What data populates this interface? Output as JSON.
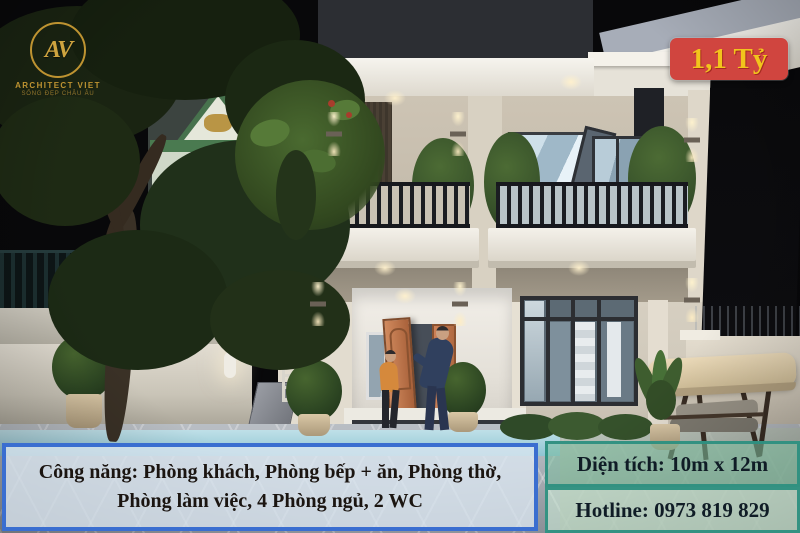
{
  "photo_alt": "Two-storey modern white house lit at night, balconies with palms, open orange front door with two people, garden swing at right, large tree and neighbour house at left",
  "brand": {
    "monogram": "AV",
    "name": "ARCHITECT VIET",
    "tagline": "SỐNG ĐẸP CHÂU ÂU"
  },
  "price": {
    "label": "1,1 Tỷ",
    "bg_color": "#d0453f",
    "text_color": "#f2c41c"
  },
  "features": {
    "line1": "Công năng: Phòng khách, Phòng bếp + ăn, Phòng thờ,",
    "line2": "Phòng làm việc, 4 Phòng ngủ, 2 WC",
    "border_color": "#3a6ed0",
    "text_color": "#1b1511"
  },
  "area": {
    "label": "Diện tích: 10m x 12m",
    "border_color": "#2d8f80",
    "text_color": "#101c26"
  },
  "hotline": {
    "label": "Hotline: 0973 819 829",
    "border_color": "#2d8f80",
    "text_color": "#101c26"
  }
}
